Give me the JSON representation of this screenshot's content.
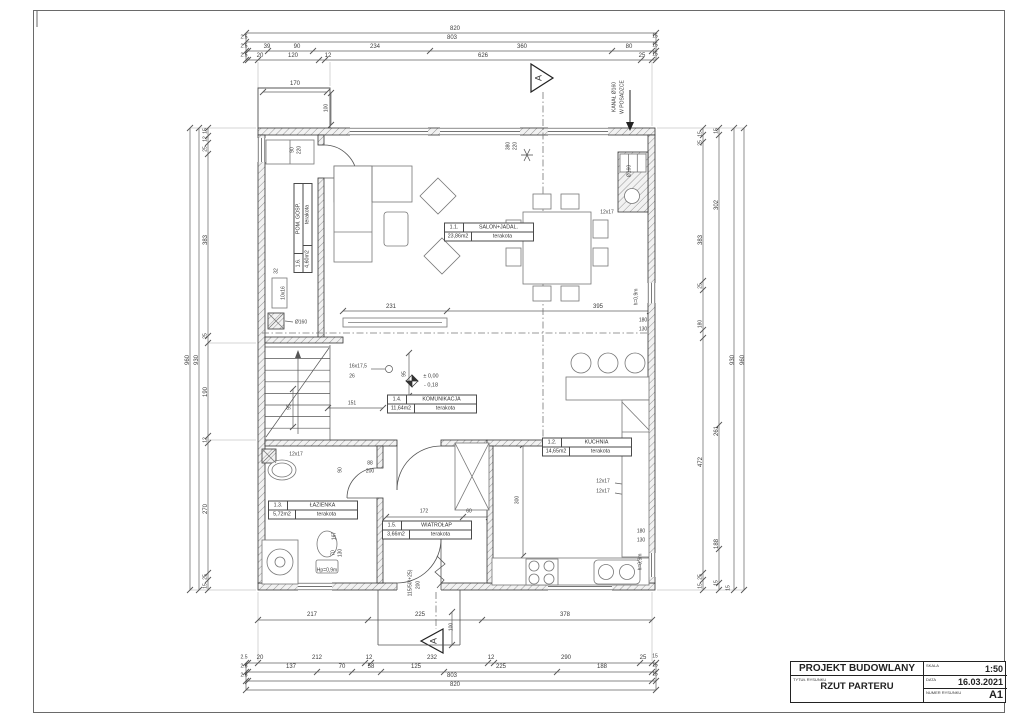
{
  "title_block": {
    "project_label": "PROJEKT BUDOWLANY",
    "title_caption": "TYTUŁ RYSUNKU",
    "drawing_title": "RZUT PARTERU",
    "scale_caption": "SKALA",
    "scale": "1:50",
    "date_caption": "DATA",
    "date": "16.03.2021",
    "number_caption": "NUMER RYSUNKU",
    "number": "A1"
  },
  "rooms": [
    {
      "id": "1.1.",
      "name": "SALON+JADAL.",
      "area": "23,86m2",
      "floor": "terakota",
      "x": 489,
      "y": 232,
      "rot": 0
    },
    {
      "id": "1.2.",
      "name": "KUCHNIA",
      "area": "14,65m2",
      "floor": "terakota",
      "x": 587,
      "y": 447,
      "rot": 0
    },
    {
      "id": "1.3.",
      "name": "ŁAZIENKA",
      "area": "5,72m2",
      "floor": "terakota",
      "x": 313,
      "y": 510,
      "rot": 0
    },
    {
      "id": "1.4.",
      "name": "KOMUNIKACJA",
      "area": "11,64m2",
      "floor": "terakota",
      "x": 432,
      "y": 404,
      "rot": 0
    },
    {
      "id": "1.5.",
      "name": "WIATROŁAP",
      "area": "3,66m2",
      "floor": "terakota",
      "x": 427,
      "y": 530,
      "rot": 0
    },
    {
      "id": "1.6.",
      "name": "POM. GOSP.",
      "area": "4,60m2",
      "floor": "terakota",
      "x": 303,
      "y": 228,
      "rot": -90
    }
  ],
  "labels": [
    {
      "t": "820",
      "x": 455,
      "y": 29
    },
    {
      "t": "2.5",
      "x": 244,
      "y": 38,
      "s": 5
    },
    {
      "t": "803",
      "x": 452,
      "y": 38
    },
    {
      "t": "15",
      "x": 655,
      "y": 37,
      "s": 5
    },
    {
      "t": "2.5",
      "x": 244,
      "y": 47,
      "s": 5
    },
    {
      "t": "39",
      "x": 267,
      "y": 47
    },
    {
      "t": "90",
      "x": 297,
      "y": 47
    },
    {
      "t": "234",
      "x": 375,
      "y": 47
    },
    {
      "t": "360",
      "x": 522,
      "y": 47
    },
    {
      "t": "80",
      "x": 629,
      "y": 47
    },
    {
      "t": "15",
      "x": 655,
      "y": 46,
      "s": 5
    },
    {
      "t": "2.5",
      "x": 244,
      "y": 56,
      "s": 5
    },
    {
      "t": "20",
      "x": 260,
      "y": 56
    },
    {
      "t": "120",
      "x": 293,
      "y": 56
    },
    {
      "t": "12",
      "x": 328,
      "y": 56
    },
    {
      "t": "626",
      "x": 483,
      "y": 56
    },
    {
      "t": "25",
      "x": 642,
      "y": 56
    },
    {
      "t": "15",
      "x": 655,
      "y": 55,
      "s": 5
    },
    {
      "t": "217",
      "x": 312,
      "y": 615
    },
    {
      "t": "225",
      "x": 420,
      "y": 615
    },
    {
      "t": "100",
      "x": 452,
      "y": 627,
      "r": -90,
      "s": 5
    },
    {
      "t": "378",
      "x": 565,
      "y": 615
    },
    {
      "t": "2.5",
      "x": 244,
      "y": 658,
      "s": 5
    },
    {
      "t": "20",
      "x": 260,
      "y": 658
    },
    {
      "t": "212",
      "x": 317,
      "y": 658
    },
    {
      "t": "12",
      "x": 369,
      "y": 658
    },
    {
      "t": "232",
      "x": 432,
      "y": 658
    },
    {
      "t": "12",
      "x": 491,
      "y": 658
    },
    {
      "t": "290",
      "x": 566,
      "y": 658
    },
    {
      "t": "25",
      "x": 643,
      "y": 658
    },
    {
      "t": "15",
      "x": 655,
      "y": 657,
      "s": 5
    },
    {
      "t": "2.5",
      "x": 244,
      "y": 667,
      "s": 5
    },
    {
      "t": "137",
      "x": 291,
      "y": 667
    },
    {
      "t": "70",
      "x": 342,
      "y": 667
    },
    {
      "t": "58",
      "x": 371,
      "y": 667
    },
    {
      "t": "125",
      "x": 416,
      "y": 667
    },
    {
      "t": "225",
      "x": 501,
      "y": 667
    },
    {
      "t": "188",
      "x": 602,
      "y": 667
    },
    {
      "t": "15",
      "x": 655,
      "y": 666,
      "s": 5
    },
    {
      "t": "2.5",
      "x": 244,
      "y": 676,
      "s": 5
    },
    {
      "t": "803",
      "x": 452,
      "y": 676
    },
    {
      "t": "15",
      "x": 655,
      "y": 675,
      "s": 5
    },
    {
      "t": "820",
      "x": 455,
      "y": 685
    },
    {
      "t": "15",
      "x": 206,
      "y": 131,
      "r": -90,
      "s": 5
    },
    {
      "t": "12",
      "x": 206,
      "y": 139,
      "r": -90,
      "s": 5
    },
    {
      "t": "25",
      "x": 206,
      "y": 149,
      "r": -90,
      "s": 5
    },
    {
      "t": "383",
      "x": 206,
      "y": 240,
      "r": -90
    },
    {
      "t": "25",
      "x": 206,
      "y": 336,
      "r": -90,
      "s": 5
    },
    {
      "t": "190",
      "x": 206,
      "y": 392,
      "r": -90
    },
    {
      "t": "12",
      "x": 206,
      "y": 440,
      "r": -90,
      "s": 5
    },
    {
      "t": "270",
      "x": 206,
      "y": 509,
      "r": -90
    },
    {
      "t": "25",
      "x": 206,
      "y": 577,
      "r": -90,
      "s": 5
    },
    {
      "t": "15",
      "x": 206,
      "y": 586,
      "r": -90,
      "s": 5
    },
    {
      "t": "930",
      "x": 197,
      "y": 360,
      "r": -90
    },
    {
      "t": "960",
      "x": 188,
      "y": 360,
      "r": -90
    },
    {
      "t": "15",
      "x": 701,
      "y": 134,
      "r": -90,
      "s": 5
    },
    {
      "t": "25",
      "x": 701,
      "y": 143,
      "r": -90,
      "s": 5
    },
    {
      "t": "383",
      "x": 701,
      "y": 240,
      "r": -90
    },
    {
      "t": "25",
      "x": 701,
      "y": 286,
      "r": -90,
      "s": 5
    },
    {
      "t": "180",
      "x": 701,
      "y": 324,
      "r": -90,
      "s": 5
    },
    {
      "t": "472",
      "x": 701,
      "y": 462,
      "r": -90
    },
    {
      "t": "25",
      "x": 701,
      "y": 577,
      "r": -90,
      "s": 5
    },
    {
      "t": "15",
      "x": 701,
      "y": 586,
      "r": -90,
      "s": 5
    },
    {
      "t": "15",
      "x": 717,
      "y": 131,
      "r": -90,
      "s": 5
    },
    {
      "t": "302",
      "x": 717,
      "y": 205,
      "r": -90
    },
    {
      "t": "261",
      "x": 717,
      "y": 431,
      "r": -90
    },
    {
      "t": "188",
      "x": 717,
      "y": 544,
      "r": -90
    },
    {
      "t": "15",
      "x": 717,
      "y": 583,
      "r": -90,
      "s": 5
    },
    {
      "t": "930",
      "x": 733,
      "y": 360,
      "r": -90
    },
    {
      "t": "960",
      "x": 743,
      "y": 360,
      "r": -90
    },
    {
      "t": "15",
      "x": 729,
      "y": 588,
      "r": -90,
      "s": 5
    },
    {
      "t": "170",
      "x": 295,
      "y": 84
    },
    {
      "t": "100",
      "x": 327,
      "y": 108,
      "r": -90,
      "s": 5
    },
    {
      "t": "90",
      "x": 293,
      "y": 150,
      "r": -90,
      "s": 5
    },
    {
      "t": "220",
      "x": 300,
      "y": 150,
      "r": -90,
      "s": 5
    },
    {
      "t": "380",
      "x": 509,
      "y": 146,
      "r": -90,
      "s": 5
    },
    {
      "t": "220",
      "x": 516,
      "y": 146,
      "r": -90,
      "s": 5
    },
    {
      "t": "KANAŁ Ø160",
      "x": 615,
      "y": 97,
      "r": -90,
      "s": 5
    },
    {
      "t": "W POSADZCE",
      "x": 623,
      "y": 97,
      "r": -90,
      "s": 5
    },
    {
      "t": "Ø160",
      "x": 630,
      "y": 171,
      "r": -90,
      "s": 5
    },
    {
      "t": "12x17",
      "x": 607,
      "y": 213,
      "s": 5
    },
    {
      "t": "32",
      "x": 277,
      "y": 271,
      "r": -90,
      "s": 5
    },
    {
      "t": "10x16",
      "x": 284,
      "y": 293,
      "r": -90,
      "s": 5
    },
    {
      "t": "Ø160",
      "x": 301,
      "y": 323,
      "s": 5
    },
    {
      "t": "16x17,5",
      "x": 358,
      "y": 367,
      "s": 5
    },
    {
      "t": "26",
      "x": 352,
      "y": 377,
      "s": 5
    },
    {
      "t": "95",
      "x": 405,
      "y": 374,
      "r": -90,
      "s": 5
    },
    {
      "t": "95",
      "x": 290,
      "y": 407,
      "r": -90,
      "s": 5
    },
    {
      "t": "151",
      "x": 352,
      "y": 404,
      "s": 5
    },
    {
      "t": "± 0,00",
      "x": 431,
      "y": 377,
      "s": 5.5
    },
    {
      "t": "- 0,18",
      "x": 431,
      "y": 386,
      "s": 5.5
    },
    {
      "t": "231",
      "x": 391,
      "y": 307
    },
    {
      "t": "395",
      "x": 598,
      "y": 307
    },
    {
      "t": "180",
      "x": 643,
      "y": 321,
      "s": 5
    },
    {
      "t": "130",
      "x": 643,
      "y": 330,
      "s": 5
    },
    {
      "t": "h=0,9m",
      "x": 637,
      "y": 297,
      "r": -90,
      "s": 5
    },
    {
      "t": "h=0,9m",
      "x": 641,
      "y": 562,
      "r": -90,
      "s": 5
    },
    {
      "t": "12x17",
      "x": 603,
      "y": 482,
      "s": 5
    },
    {
      "t": "12x17",
      "x": 603,
      "y": 492,
      "s": 5
    },
    {
      "t": "180",
      "x": 641,
      "y": 532,
      "s": 5
    },
    {
      "t": "130",
      "x": 641,
      "y": 541,
      "s": 5
    },
    {
      "t": "88",
      "x": 370,
      "y": 464,
      "s": 5
    },
    {
      "t": "200",
      "x": 370,
      "y": 472,
      "s": 5
    },
    {
      "t": "90",
      "x": 341,
      "y": 470,
      "r": -90,
      "s": 5
    },
    {
      "t": "12x17",
      "x": 296,
      "y": 455,
      "s": 5
    },
    {
      "t": "172",
      "x": 424,
      "y": 512,
      "s": 5
    },
    {
      "t": "60",
      "x": 469,
      "y": 512,
      "s": 5
    },
    {
      "t": "300",
      "x": 518,
      "y": 500,
      "r": -90,
      "s": 5
    },
    {
      "t": "167",
      "x": 335,
      "y": 536,
      "r": -90,
      "s": 5
    },
    {
      "t": "70",
      "x": 334,
      "y": 553,
      "r": -90,
      "s": 5
    },
    {
      "t": "130",
      "x": 341,
      "y": 553,
      "r": -90,
      "s": 5
    },
    {
      "t": "Hp=0,9m",
      "x": 327,
      "y": 571,
      "s": 5
    },
    {
      "t": "115/50(+25)",
      "x": 411,
      "y": 583,
      "r": -90,
      "s": 5
    },
    {
      "t": "200",
      "x": 419,
      "y": 585,
      "r": -90,
      "s": 5
    },
    {
      "t": "A",
      "x": 539,
      "y": 78,
      "r": -90,
      "s": 9
    },
    {
      "t": "A",
      "x": 434,
      "y": 641,
      "r": -90,
      "s": 9
    }
  ]
}
